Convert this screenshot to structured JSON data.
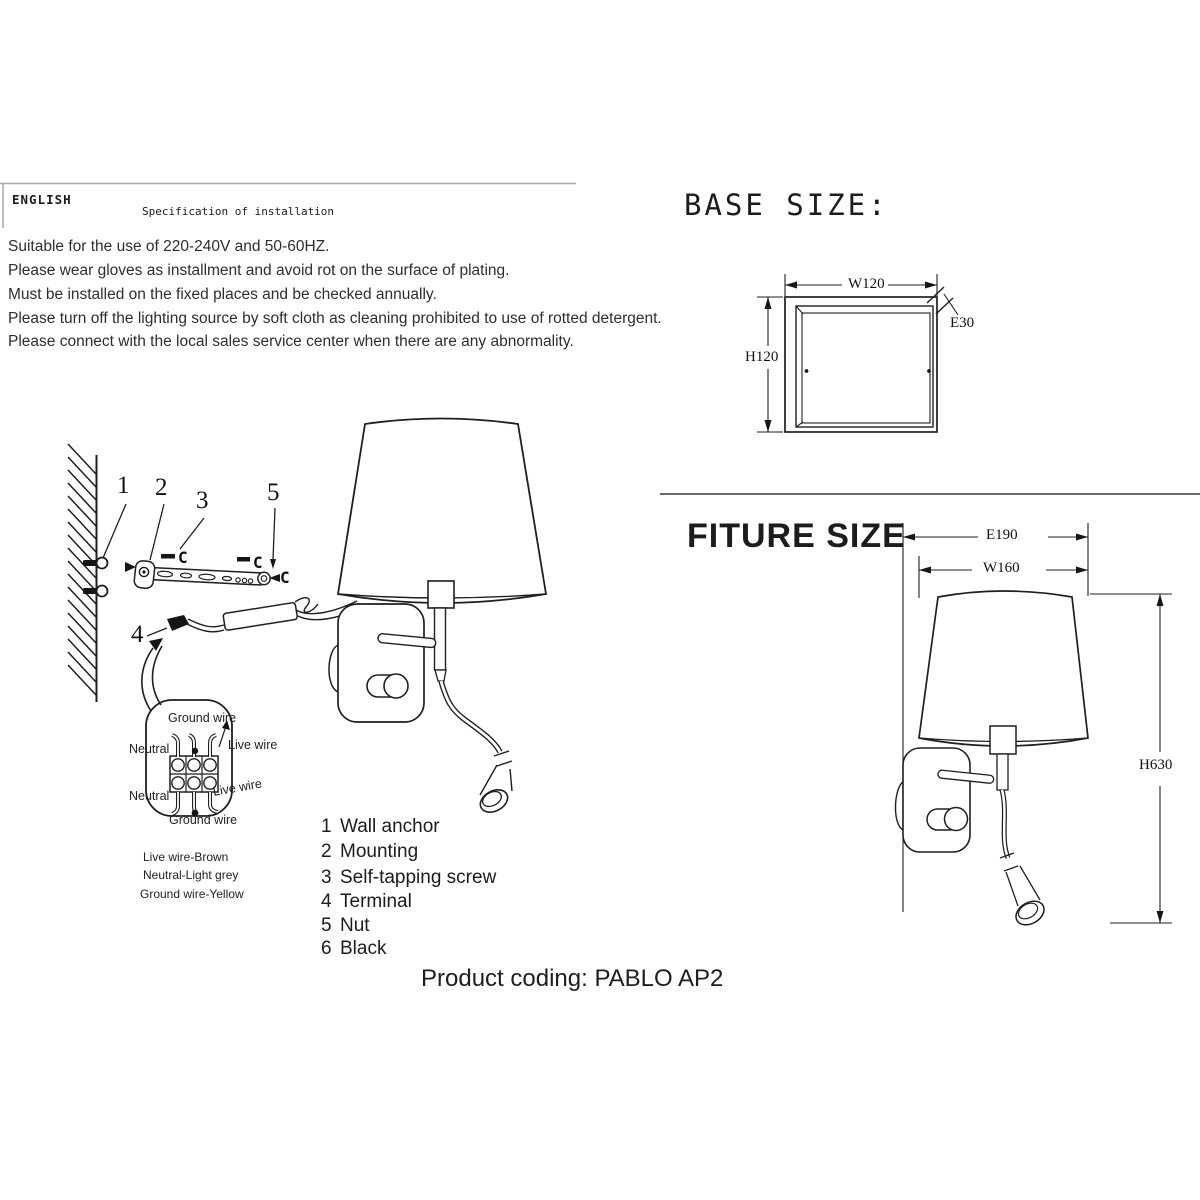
{
  "header": {
    "language": "ENGLISH",
    "title": "Specification of installation",
    "notes": [
      "Suitable for the use of 220-240V and 50-60HZ.",
      "Please wear gloves as installment and avoid rot on the surface of plating.",
      "Must be installed on the fixed places and be checked annually.",
      "Please turn off the lighting source by soft cloth as cleaning prohibited to use of rotted detergent.",
      "Please connect with the local sales service center when there are any abnormality."
    ]
  },
  "installation": {
    "callouts": {
      "n1": "1",
      "n2": "2",
      "n3": "3",
      "n4": "4",
      "n5": "5",
      "c_left": "C",
      "c_mid": "C",
      "c_right": "C"
    },
    "terminal_labels": {
      "ground_top": "Ground wire",
      "neutral_top": "Neutral",
      "live_top": "Live wire",
      "neutral_bottom": "Neutral",
      "live_bottom": "Live wire",
      "ground_bottom": "Ground wire"
    },
    "wire_key": [
      "Live wire-Brown",
      "Neutral-Light grey",
      "Ground wire-Yellow"
    ]
  },
  "parts_list": [
    {
      "num": "1",
      "name": "Wall anchor"
    },
    {
      "num": "2",
      "name": "Mounting"
    },
    {
      "num": "3",
      "name": "Self-tapping screw"
    },
    {
      "num": "4",
      "name": "Terminal"
    },
    {
      "num": "5",
      "name": "Nut"
    },
    {
      "num": "6",
      "name": "Black"
    }
  ],
  "base_size": {
    "heading": "BASE SIZE:",
    "width": "W120",
    "height": "H120",
    "edge": "E30"
  },
  "fixture_size": {
    "heading": "FITURE SIZE",
    "extension": "E190",
    "width": "W160",
    "height": "H630"
  },
  "footer": {
    "product_coding": "Product coding: PABLO AP2"
  }
}
